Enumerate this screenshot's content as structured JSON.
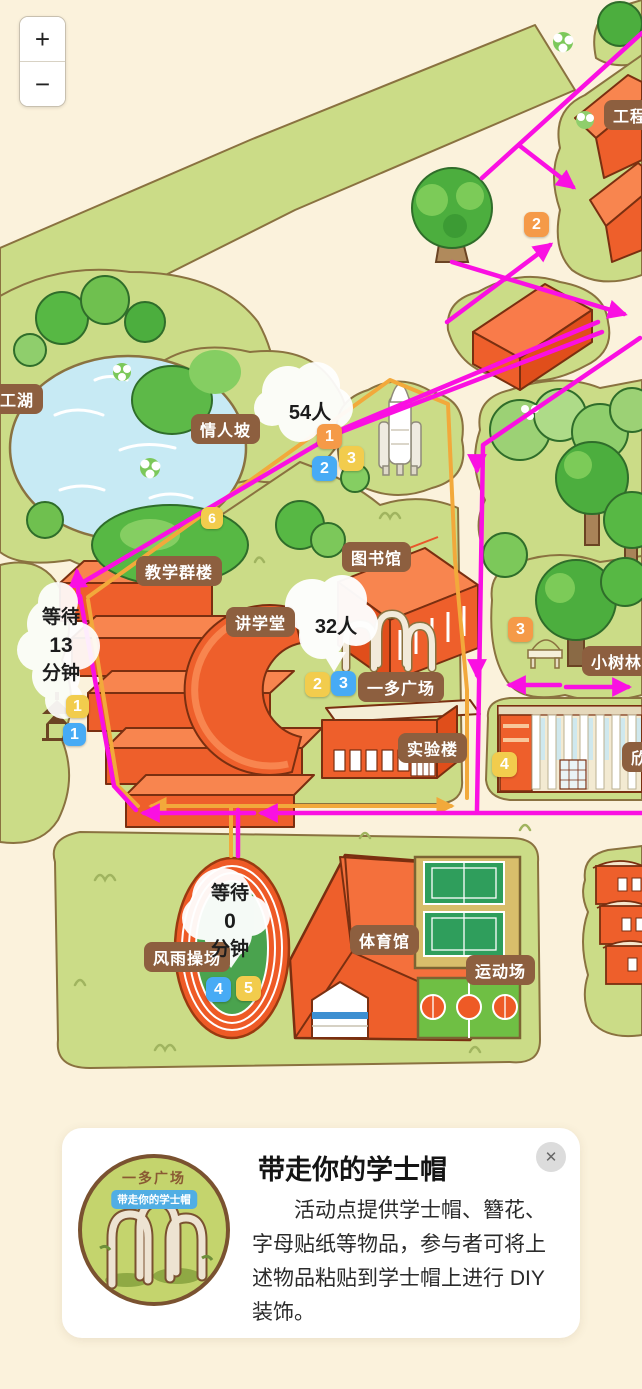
{
  "controls": {
    "zoom_in": "+",
    "zoom_out": "−"
  },
  "map": {
    "labels": {
      "lake": "人工湖",
      "lovers_slope": "情人坡",
      "teaching_complex": "教学群楼",
      "lecture_hall": "讲学堂",
      "library": "图书馆",
      "yiduo_square": "一多广场",
      "lab_building": "实验楼",
      "engineering": "工程",
      "grove": "小树林",
      "xin_building": "欣",
      "gymnasium": "体育馆",
      "sports_field": "运动场",
      "windrain_playground": "风雨操场"
    },
    "crowd": {
      "lovers_slope": "54人",
      "yiduo_square": "32人"
    },
    "wait": {
      "pavilion": {
        "l1": "等待",
        "l2": "13",
        "l3": "分钟"
      },
      "playground": {
        "l1": "等待",
        "l2": "0",
        "l3": "分钟"
      }
    },
    "badges": {
      "route_north_orange2": "2",
      "rocket_orange1": "1",
      "rocket_blue2": "2",
      "rocket_yellow3": "3",
      "path_yellow6": "6",
      "pavilion_yellow1": "1",
      "pavilion_blue1": "1",
      "square_yellow2": "2",
      "square_blue3": "3",
      "grove_orange3": "3",
      "xin_yellow4": "4",
      "playground_blue4": "4",
      "playground_yellow5": "5"
    }
  },
  "card": {
    "title": "带走你的学士帽",
    "body": "活动点提供学士帽、簪花、字母贴纸等物品，参与者可将上述物品粘贴到学士帽上进行 DIY 装饰。",
    "thumb_title": "一多广场",
    "thumb_badge": "带走你的学士帽",
    "close_label": "✕"
  },
  "colors": {
    "background": "#FBF2DC",
    "hedge_green": "#CBDC87",
    "building_orange": "#EE5F2B",
    "route_magenta": "#FA10E2",
    "route_orange": "#F2A93B",
    "badge_orange": "#F59A48",
    "badge_blue": "#47ABF5",
    "badge_yellow": "#F2CC4D",
    "label_brown": "#8D5F3F",
    "lake_blue": "#C7EAF4"
  }
}
